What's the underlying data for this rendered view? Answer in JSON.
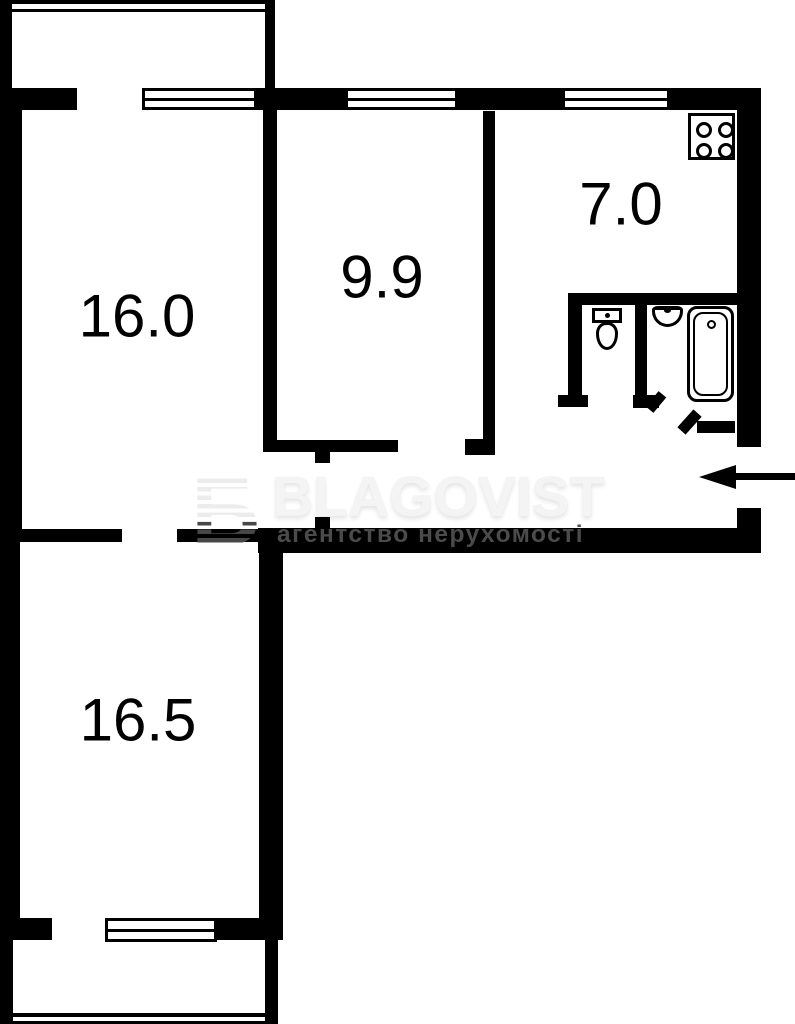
{
  "plan": {
    "type": "apartment-floor-plan",
    "rooms": [
      {
        "id": "room-16-0",
        "area_label": "16.0"
      },
      {
        "id": "room-9-9",
        "area_label": "9.9"
      },
      {
        "id": "kitchen-7-0",
        "area_label": "7.0"
      },
      {
        "id": "room-16-5",
        "area_label": "16.5"
      }
    ],
    "fixtures": [
      "stove-icon",
      "toilet-icon",
      "sink-icon",
      "bathtub-icon",
      "entrance-arrow-icon",
      "window",
      "balcony"
    ],
    "watermark": {
      "logo_letter": "Б",
      "brand": "BLAGOVIST",
      "tagline": "агентство нерухомості"
    },
    "colors": {
      "wall": "#000000",
      "background": "#ffffff",
      "watermark_brand": "#f4f4f4",
      "watermark_tagline": "#4b4b4b",
      "watermark_logo_top": "#ececec",
      "watermark_logo_bottom": "#474747"
    }
  }
}
